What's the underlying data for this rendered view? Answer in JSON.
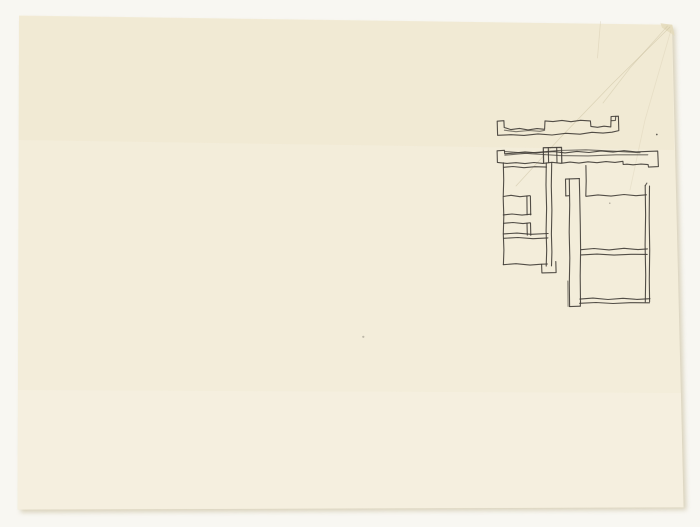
{
  "colors": {
    "scan_background": "#f8f7f2",
    "paper": "#f3edda",
    "paper_tint_warm": "#ede3c6",
    "paper_tint_light": "#f9f4e8",
    "shadow": "#cdc3a6",
    "ink": "#403c36",
    "crease": "#c3b795",
    "corner_fold": "#e4dabb"
  },
  "paper": {
    "points": "19,15.5 672,24.8 683.6,507.4 17.6,509.6",
    "shadow_points": "22,19 675,28 686.5,510 20.5,512.5",
    "corner_fold_d": "M660.5,23.2 L672.3,24.7 L674.6,35.8 L662,27.6 Z",
    "creases": [
      {
        "d": "M670,27 L612,84 L560,138 L516,186",
        "o": 0.45
      },
      {
        "d": "M667.5,26 L630,68 L603,103",
        "o": 0.38
      },
      {
        "d": "M600.5,21.5 L597.5,58",
        "o": 0.3
      },
      {
        "d": "M671,30 L645,120 L630,190",
        "o": 0.22
      }
    ]
  },
  "sketch": {
    "description": "freehand ink sketch of a building plan: two long notched wall bars above a cluster of rectangular rooms with a tall narrow vertical element",
    "stroke_width": 1.1,
    "strokes": [
      {
        "name": "top-bar-outline",
        "d": "M497.6,135.3 L497.2,121.2 L503.9,120.7 L504.2,127.5 L511,129.6 L519.5,128.4 L528,129.9 L537,128.6 L544.6,129.3 L545,120.9 L553,121.6 L562,120.4 L571,121.7 L580.5,120.3 L590.4,120.9 L590.9,126.4 L597.5,127.3 L604,126.2 L610.8,126.9 L611.1,116.5 L618.4,116.2 L618.8,130.6 L612,132.2 L603,133.1 L592,132.3 L580,134.2 L566,133.3 L552,135 L538,133.9 L524,135.4 L511,134.7 L497.6,135.3"
      },
      {
        "name": "top-bar-tab-detail",
        "d": "M611.2,120.7 L615.4,120.4 L615.7,116.4",
        "o": 0.8
      },
      {
        "name": "top-bar-doubled-edge",
        "d": "M504.4,130.2 L516,131.7 L529,130.5 L540,131.3 L544.6,130.3",
        "o": 0.65
      },
      {
        "name": "second-bar-outline",
        "d": "M497.4,162.4 L497.1,150.8 L504.4,150.3 L504.7,153.8 L514,153.1 L525,151.9 L536,152.8 L543.4,152.2 L554,151.6 L565,152.9 L577,151.4 L589,152.5 L601,150.9 L613,152.1 L624,150.7 L636,151.9 L647.6,151.4 L657.7,151.1 L658.4,166.6 L648.5,167.1 L648.1,164.6 L641,164.1 L633,164.8 L627,164.2 L623.2,164.5 L622.9,161.3 L615,162.4 L606,161.6 L597,162.7 L588,161.8 L579,163.1 L570,162.1 L561,163.3 L552,162.3 L543,163.4 L534,162.5 L525,163.6 L516,162.7 L507,163.4 L497.4,162.4"
      },
      {
        "name": "second-bar-inner-line-a",
        "d": "M504.9,155.2 L530,152.9 L558,150.5 L586,149.8 L614,151.2 L640,152.7",
        "o": 0.7
      },
      {
        "name": "second-bar-inner-line-b",
        "d": "M504.6,151.4 L532,153.8 L560,155.6 L588,155.9 L616,154.8 L647.8,154.8",
        "o": 0.7
      },
      {
        "name": "column-block",
        "d": "M543.6,162.5 L543.3,147.7 L561.5,147.4 L561.8,162.7",
        "w": 1.25
      },
      {
        "name": "column-inner-left",
        "d": "M548.3,147.9 L548.6,162.4"
      },
      {
        "name": "column-inner-right",
        "d": "M556.7,147.6 L557,162.6"
      },
      {
        "name": "plan-left-edge",
        "d": "M503.3,162.8 L503.7,180 L503.2,198 L503.8,216 L503.3,234 L503.9,250 L503.4,264.6"
      },
      {
        "name": "left-room-top",
        "d": "M503.5,167.3 L513,166.5 L524,167.7 L535,166.7 L546.4,167.1"
      },
      {
        "name": "room-divider-1",
        "d": "M503.4,196.5 L511,195.3 L520,196.7 L529.6,195.7"
      },
      {
        "name": "small-wall-1-a",
        "d": "M526.9,196.1 L527.1,214.7"
      },
      {
        "name": "small-wall-1-b",
        "d": "M530.4,195.9 L530.7,214.9"
      },
      {
        "name": "room-divider-2",
        "d": "M503.3,214.9 L512,214 L522,215.1 L531,214.2"
      },
      {
        "name": "room-divider-3",
        "d": "M503.5,223.3 L513,222.5 L523,223.6 L530.1,222.8"
      },
      {
        "name": "small-wall-2-a",
        "d": "M527,223.3 L527.3,235.1"
      },
      {
        "name": "small-wall-2-b",
        "d": "M530.5,223.1 L530.8,235.3"
      },
      {
        "name": "thick-wall-a",
        "d": "M503.4,233.9 L517,233.1 L531,234.3 L548.1,233.5"
      },
      {
        "name": "thick-wall-b",
        "d": "M503.6,238.3 L518,237.5 L533,238.7 L547.9,237.9"
      },
      {
        "name": "left-bottom-edge",
        "d": "M503.3,264.7 L516,263.7 L530,265.1 L541.6,264.2 L547.4,264"
      },
      {
        "name": "wall-foot",
        "d": "M541.6,264.4 L541.9,272.9 L556.1,272.6 L555.8,261.6"
      },
      {
        "name": "central-wall-a",
        "d": "M546.3,162.9 L546,185 L546.6,208 L546.1,231 L546.7,250 L546.2,266.1"
      },
      {
        "name": "central-wall-b",
        "d": "M551.7,162.7 L551.3,186 L551.9,210 L551.4,234 L551.9,252 L551.5,265.9"
      },
      {
        "name": "wide-bar-cap",
        "d": "M565.8,195.9 L565.5,179.1 L579.3,178.6"
      },
      {
        "name": "wide-bar-cap-joint",
        "d": "M565.8,195.9 L569.2,195.7"
      },
      {
        "name": "wide-bar-left-edge",
        "d": "M569.3,178.9 L569.7,205 L569.2,232 L569.8,258 L569.3,284 L569.6,306.5"
      },
      {
        "name": "wide-bar-right-edge",
        "d": "M579.3,178.6 L579.8,200 L580.3,225 L580.6,250 L580.2,276 L580.5,301.9"
      },
      {
        "name": "wide-bar-right-lower",
        "d": "M580.5,301.9 L580.3,306.1"
      },
      {
        "name": "wide-bar-bottom",
        "d": "M569.6,306.6 L580.3,306.2"
      },
      {
        "name": "wide-bar-left-double",
        "d": "M567.8,281 L568.1,306.4",
        "o": 0.6
      },
      {
        "name": "room-left-edge",
        "d": "M585.9,165.5 L586.2,181 L585.8,196.1"
      },
      {
        "name": "room-top-edge",
        "d": "M586.1,196.3 L598,194.9 L611,196.1 L624,194.5 L636,195.7 L646.4,194.8"
      },
      {
        "name": "room-right-edge-a",
        "d": "M645.2,185.7 L645.6,215 L645.1,245 L645.7,275 L645.3,302"
      },
      {
        "name": "room-right-edge-b",
        "d": "M649.5,186.1 L649.2,218 L649.7,250 L649.3,280 L649.6,301.7"
      },
      {
        "name": "room-right-hook",
        "d": "M645.2,185.7 L646.9,183.1",
        "o": 0.8
      },
      {
        "name": "room-divider-a",
        "d": "M581,249.7 L594,248.5 L609,249.9 L624,248.3 L638,249.6 L647.4,248.9"
      },
      {
        "name": "room-divider-b",
        "d": "M581.2,254.9 L597,254.1 L614,255.1 L631,254.3 L647.2,254.4"
      },
      {
        "name": "room-bottom-a",
        "d": "M579.9,299.1 L593,298.1 L608,299.5 L623,298.3 L637,299.4 L649.9,298.7"
      },
      {
        "name": "room-bottom-b",
        "d": "M579.7,303.3 L596,302.5 L613,303.5 L630,302.7 L649.5,302.8"
      }
    ],
    "specks": [
      [
        656.8,
        134.5,
        0.9,
        0.8
      ],
      [
        609.8,
        203.2,
        0.7,
        0.45
      ],
      [
        363.3,
        336.8,
        1.1,
        0.3
      ]
    ]
  }
}
